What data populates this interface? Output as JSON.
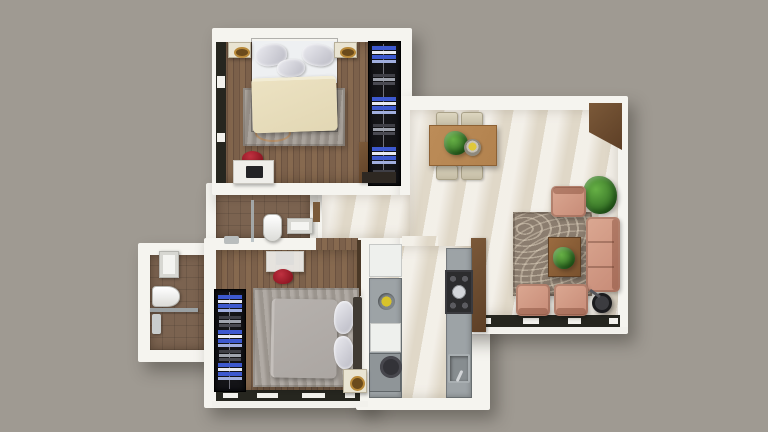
{
  "scene": {
    "type": "apartment-floor-plan-top-view-3d-render",
    "rooms": [
      {
        "name": "bedroom-master",
        "position": "top-left",
        "floor": "wood-plank",
        "furniture": [
          "double-bed",
          "cream-duvet",
          "silver-pillows",
          "gray-rug",
          "nightstand-left",
          "nightstand-right",
          "desk",
          "red-chair",
          "monitor",
          "open-wardrobe-with-folded-clothes",
          "side-cabinet",
          "dresser"
        ],
        "windows": [
          "left-wall-window-band"
        ]
      },
      {
        "name": "living-dining",
        "position": "top-right",
        "floor": "cream-tile",
        "furniture": [
          "dining-table",
          "dining-chairs-x4",
          "table-plant",
          "fruit-bowl",
          "corner-tv-cabinet",
          "corner-plant",
          "armchair-top",
          "three-seat-sofa",
          "coffee-table",
          "coffee-table-plant",
          "armchair-bottom-left",
          "armchair-bottom-right",
          "floor-lamp",
          "patterned-area-rug"
        ],
        "windows": [
          "bottom-wall-window-band"
        ]
      },
      {
        "name": "kitchen",
        "position": "bottom-center",
        "floor": "cream-tile",
        "furniture": [
          "fridge",
          "left-counter",
          "round-sink-bowl",
          "dishwasher",
          "base-cabinet",
          "waste-bin",
          "tall-cabinet-column",
          "right-counter",
          "cooktop-4-burners",
          "sink-with-faucet"
        ]
      },
      {
        "name": "bedroom-second",
        "position": "bottom-left",
        "floor": "wood-plank",
        "furniture": [
          "double-bed",
          "gray-duvet",
          "silver-pillows",
          "dark-headboard",
          "nightstand",
          "gray-rug",
          "desk",
          "red-chair",
          "monitor",
          "open-wardrobe-with-folded-clothes"
        ],
        "windows": [
          "bottom-wall-window-band"
        ]
      },
      {
        "name": "bathroom-main",
        "position": "middle-left",
        "floor": "brown-tile",
        "furniture": [
          "shower-glass-partition",
          "shower-set",
          "toilet",
          "washbasin",
          "wall-shelf"
        ]
      },
      {
        "name": "bathroom-second",
        "position": "far-left",
        "floor": "brown-tile",
        "furniture": [
          "washbasin",
          "toilet",
          "glass-shelf",
          "shower-set"
        ]
      },
      {
        "name": "hallway",
        "position": "center",
        "floor": "cream-tile",
        "furniture": []
      }
    ],
    "colors": {
      "bg": "#9f9a92",
      "wall": "#f5f4ef",
      "woodA": "#7c614b",
      "bathfloor": "#7b6350",
      "tile": "#e7e0d2",
      "window": "#26261f",
      "counter": "#9da3a6",
      "appliance": "#eef0ed",
      "wardrobe": "#141417",
      "clothes": "#3d59cf",
      "pillow": "#b9b9c3",
      "salmon": "#c78b77",
      "rugbrown": "#8b7d6f",
      "ruggray": "#9d968e",
      "duvetcream": "#e2d7b4",
      "duvetgray": "#aba6a2",
      "woodtable": "#b2824e",
      "woodcab": "#5d3f26",
      "stove": "#2c2c2e",
      "red": "#8e1622",
      "green": "#2f6a22",
      "gold": "#b98a3a"
    }
  }
}
